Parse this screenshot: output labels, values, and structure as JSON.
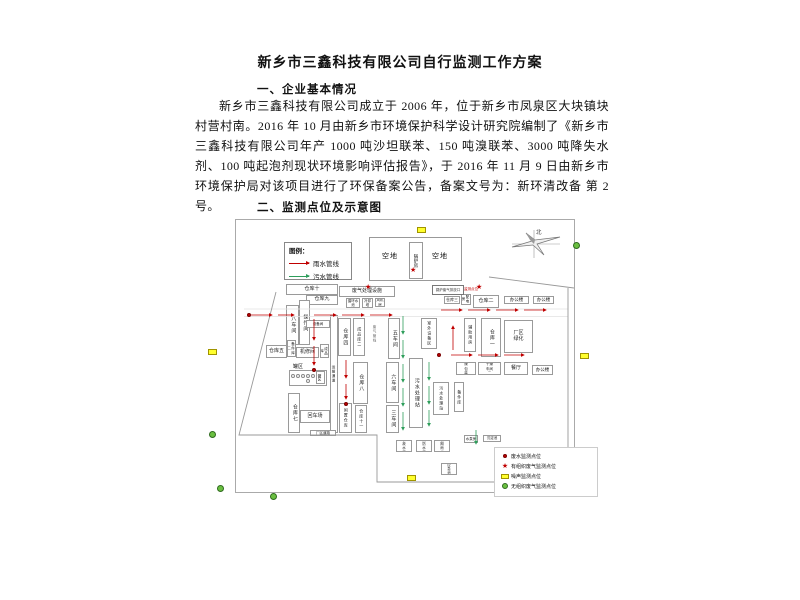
{
  "document": {
    "title": "新乡市三鑫科技有限公司自行监测工作方案",
    "heading1": "一、企业基本情况",
    "paragraph": "新乡市三鑫科技有限公司成立于 2006 年，位于新乡市凤泉区大块镇块村营村南。2016 年 10 月由新乡市环境保护科学设计研究院编制了《新乡市三鑫科技有限公司年产 1000 吨沙坦联苯、150 吨溴联苯、3000 吨降失水剂、100 吨起泡剂现状环境影响评估报告》，于 2016 年 11 月 9 日由新乡市环境保护局对该项目进行了环保备案公告，备案文号为：新环清改备 第 2 号。",
    "heading2": "二、监测点位及示意图"
  },
  "diagram": {
    "pipe_legend": {
      "title": "图例：",
      "rain": "雨水管线",
      "sewage": "污水管线"
    },
    "compass": "北",
    "open_space_left": "空地",
    "open_space_right": "空地",
    "boiler_room": "锅炉房",
    "stack_note_black": "锅炉废气排放口",
    "stack_note_red": "监测点位",
    "tank_area_label": "罐区",
    "tank_area_sub": "罐区",
    "icons": {
      "star": "★"
    },
    "colors": {
      "rain": "#c00000",
      "sewage": "#2e9e5b",
      "noise_fill": "#ffff2e",
      "fugitive_fill": "#6abf40"
    },
    "buildings": {
      "ck10": "仓库十",
      "ck9": "仓库九",
      "cj8": "八车间",
      "czj": "操作间",
      "sbj1": "设备间",
      "bjk2": "备件库二",
      "ck5": "仓库五",
      "jxj": "机修间",
      "cpk": "成品库",
      "ck7": "仓库七",
      "hcc": "回车场",
      "ysld": "运输通道",
      "cqdl": "厂区道路",
      "fqclss": "废气处理设施",
      "xhsc": "循环水池",
      "lqt": "冷却塔",
      "fjf": "风机房",
      "ck4": "仓库四",
      "cpk2": "成品库二",
      "cj5": "五车间",
      "fqgx": "废气管线",
      "ck8": "仓库八",
      "cj6": "六车间",
      "cj3": "三车间",
      "xzck": "闲置仓库",
      "ck11": "仓库十一",
      "wsclz1": "污水处理站",
      "swsbq": "室外设备区",
      "fzyf": "辅助用房",
      "ck1": "仓库一",
      "cqlh": "厂区绿化",
      "ck3": "仓库三",
      "pdf": "配电房",
      "ck2": "仓库二",
      "bgl1": "办公楼",
      "bgl2": "办公楼",
      "gzbzj": "干燥包装间",
      "gzcj2": "干燥车间二",
      "ct": "餐厅",
      "bgl3": "办公楼",
      "wsclz2": "污水处理站",
      "bjk1": "备件库",
      "sgsc": "事故水池",
      "xfsc": "消防水池",
      "cqys": "初期雨水",
      "yjc": "应急池",
      "sbf": "水泵房",
      "cdc": "沉淀池"
    },
    "marker_legend": {
      "wastewater": "废水监测点位",
      "organized_gas": "有组织废气监测点位",
      "noise": "噪声监测点位",
      "fugitive_gas": "无组织废气监测点位"
    }
  }
}
